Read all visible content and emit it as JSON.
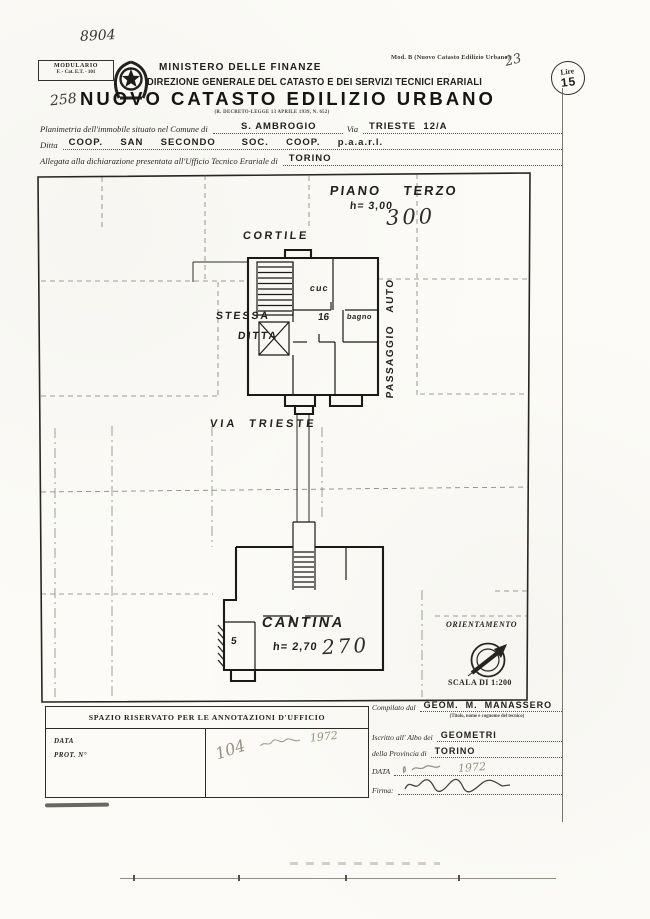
{
  "colors": {
    "ink": "#1e1d1b",
    "paper": "#fcfbf7",
    "faint": "#968f82"
  },
  "header": {
    "handwritten_ref": "8904",
    "mod_label": "Mod. B (Nuovo Catasto Edilizio Urbano)",
    "handwritten_page": "23",
    "modulario_line1": "MODULARIO",
    "modulario_line2": "F. - Cat. E.T. - 101",
    "ministry": "MINISTERO DELLE FINANZE",
    "direzione": "DIREZIONE GENERALE DEL CATASTO E DEI SERVIZI TECNICI ERARIALI",
    "stamp_currency": "Lire",
    "stamp_value": "15",
    "handwritten_number": "258",
    "title": "NUOVO CATASTO EDILIZIO URBANO",
    "title_law": "(R. DECRETO-LEGGE 13 APRILE 1939, N. 652)"
  },
  "form": {
    "comune_label": "Planimetria dell'immobile situato nel Comune di",
    "comune_value": "S. AMBROGIO",
    "via_label": "Via",
    "via_value": "TRIESTE  12/A",
    "ditta_label": "Ditta",
    "ditta_value": "COOP.  SAN  SECONDO   SOC.  COOP.  p.a.a.r.l.",
    "ufficio_label": "Allegata alla dichiarazione presentata all'Ufficio Tecnico Erariale di",
    "ufficio_value": "TORINO"
  },
  "plan_terzo": {
    "name": "PIANO    TERZO",
    "height": "h= 3,00",
    "area": "300",
    "cortile": "CORTILE",
    "stessa": "STESSA",
    "ditta": "DITTA",
    "cucina": "cuc",
    "room": "16",
    "bagno": "bagno",
    "passaggio": "PASSAGGIO   AUTO",
    "via": "VIA  TRIESTE"
  },
  "plan_cantina": {
    "name": "CANTINA",
    "height": "h= 2,70",
    "area": "270",
    "room": "5"
  },
  "orientation": {
    "label": "ORIENTAMENTO",
    "scale": "SCALA DI 1:200"
  },
  "office": {
    "header": "SPAZIO RISERVATO PER LE ANNOTAZIONI D'UFFICIO",
    "data_label": "DATA",
    "prot_label": "PROT. N°",
    "handwritten": "104",
    "stamp_year": "1972"
  },
  "compiler": {
    "compilato_label": "Compilato dal",
    "name": "GEOM.  M.  MANASSERO",
    "name_note": "(Titolo, nome e cognome del tecnico)",
    "albo_label": "Iscritto all' Albo dei",
    "albo_value": "GEOMETRI",
    "provincia_label": "della Provincia di",
    "provincia_value": "TORINO",
    "data_label": "DATA",
    "data_stamp": "1972",
    "firma_label": "Firma:"
  }
}
